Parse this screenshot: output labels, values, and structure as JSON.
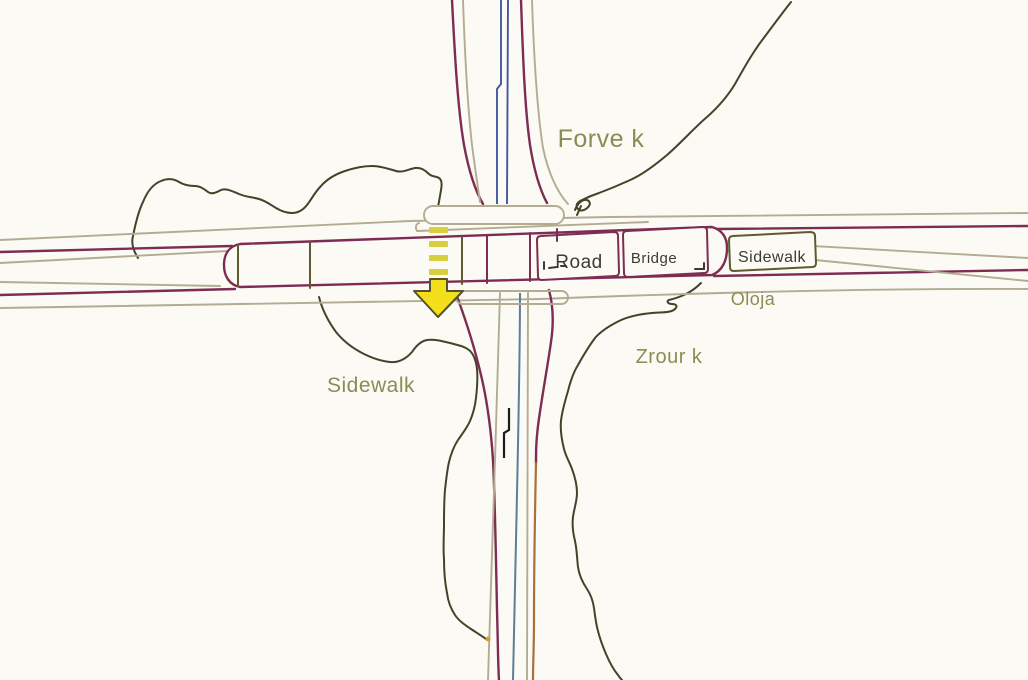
{
  "map": {
    "labels": {
      "forve": "Forve k",
      "road": "Road",
      "bridge": "Bridge",
      "sidewalk_right": "Sidewalk",
      "oloja": "Oloja",
      "zrour": "Zrour k",
      "sidewalk_left": "Sidewalk"
    },
    "colors": {
      "background": "#fbfaf4",
      "road-casing": "#7e2d52",
      "road-edge": "#b3ac93",
      "contour": "#45422a",
      "waterway-blue": "#41589f",
      "waterway-teal": "#5d7d99",
      "path-brown": "#a8713c",
      "gps-black": "#1c1c1c",
      "annotation-box": "#5f5a30",
      "label-olive": "#8d8b55",
      "label-dark": "#3b3a33",
      "arrow-fill": "#f4e01a",
      "arrow-outline": "#56522c",
      "dash-yellow": "#d9cf3e",
      "dot-gold": "#c9a03a"
    }
  }
}
